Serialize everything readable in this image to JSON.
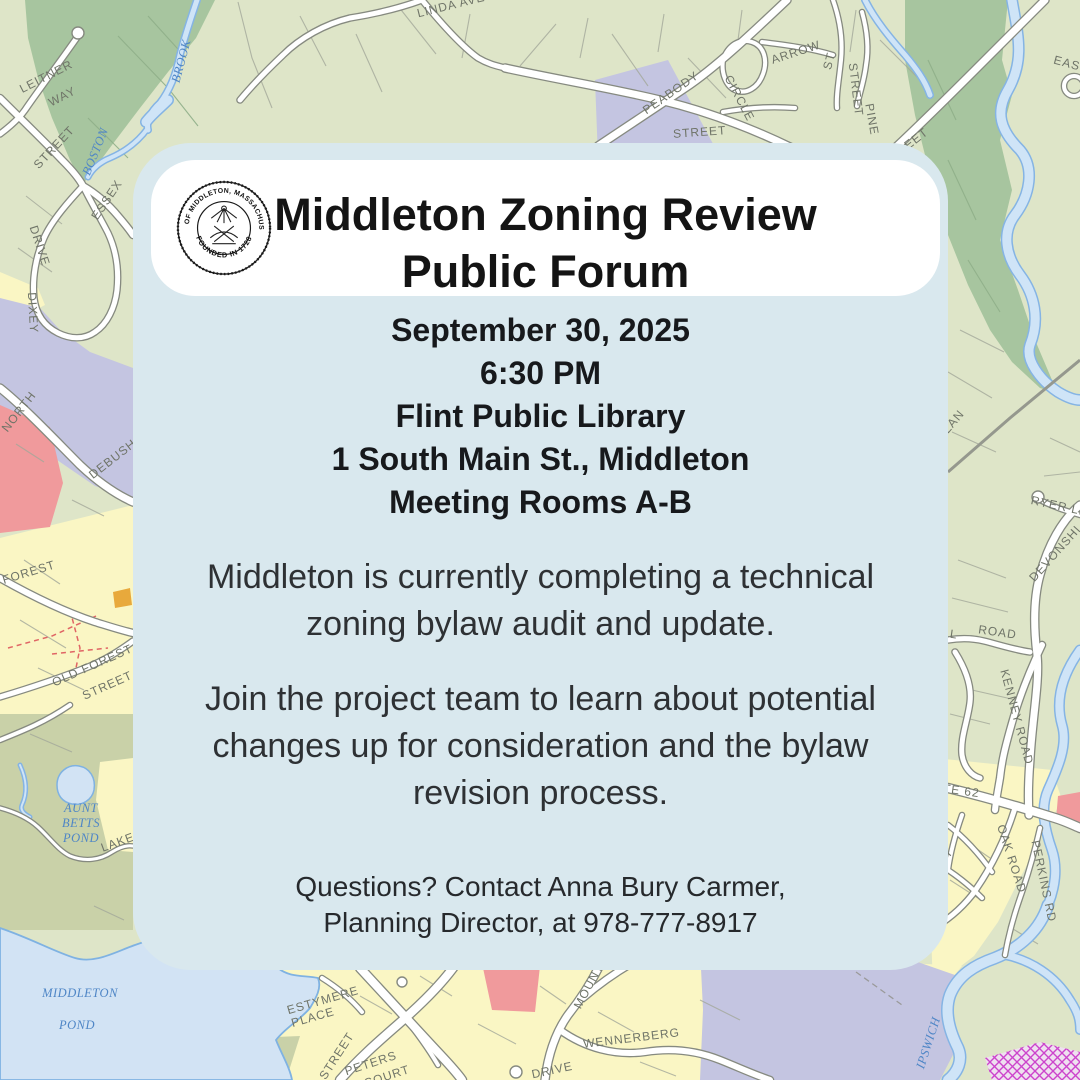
{
  "card": {
    "title": {
      "line1": "Middleton Zoning Review",
      "line2": "Public Forum"
    },
    "seal": {
      "ring_top": "TOWN OF MIDDLETON, MASSACHUSETTS",
      "ring_bottom": "FOUNDED IN 1728"
    },
    "details": [
      "September 30, 2025",
      "6:30 PM",
      "Flint Public Library",
      "1 South Main St., Middleton",
      "Meeting Rooms A-B"
    ],
    "body": {
      "p1": [
        "Middleton is currently completing a technical",
        "zoning bylaw audit and update."
      ],
      "p2": [
        "Join the project team to learn about potential",
        "changes up for consideration and the bylaw",
        "revision process."
      ]
    },
    "contact": [
      "Questions? Contact Anna Bury Carmer,",
      "Planning Director, at 978-777-8917"
    ]
  },
  "colors": {
    "card_bg": "#d9e8ee",
    "pill_bg": "#ffffff",
    "title_text": "#141414",
    "body_text": "#2e3134",
    "map_sage": "#dee5c8",
    "map_forest": "#a7c59f",
    "map_olive": "#c9d1a8",
    "map_lavender": "#c4c5e1",
    "map_yellow": "#faf6c4",
    "map_pink": "#f09a9c",
    "map_orange": "#e8a93c",
    "map_water": "#cfe4f7",
    "map_water_edge": "#85b4e4",
    "road_fill": "#ffffff",
    "road_casing": "#868a80"
  },
  "map": {
    "labels": [
      {
        "t": "LEITNER",
        "x": 48,
        "y": 80,
        "r": -27,
        "k": "s"
      },
      {
        "t": "WAY",
        "x": 64,
        "y": 100,
        "r": -27,
        "k": "s"
      },
      {
        "t": "STREET",
        "x": 57,
        "y": 150,
        "r": -47,
        "k": "s"
      },
      {
        "t": "ESSEX",
        "x": 110,
        "y": 202,
        "r": -56,
        "k": "s"
      },
      {
        "t": "DRIVE",
        "x": 36,
        "y": 247,
        "r": 72,
        "k": "s"
      },
      {
        "t": "DIXEY",
        "x": 29,
        "y": 313,
        "r": 87,
        "k": "s"
      },
      {
        "t": "NORTH",
        "x": 22,
        "y": 414,
        "r": -52,
        "k": "s"
      },
      {
        "t": "DEBUSH",
        "x": 115,
        "y": 462,
        "r": -38,
        "k": "s"
      },
      {
        "t": "FOREST",
        "x": 30,
        "y": 576,
        "r": -17,
        "k": "s"
      },
      {
        "t": "OLD FOREST",
        "x": 94,
        "y": 669,
        "r": -24,
        "k": "s"
      },
      {
        "t": "STREET",
        "x": 109,
        "y": 689,
        "r": -24,
        "k": "s"
      },
      {
        "t": "LAKE",
        "x": 119,
        "y": 846,
        "r": -20,
        "k": "s"
      },
      {
        "t": "LINDA AVE",
        "x": 452,
        "y": 9,
        "r": -14,
        "k": "s"
      },
      {
        "t": "PEABODY",
        "x": 673,
        "y": 96,
        "r": -35,
        "k": "s"
      },
      {
        "t": "ARROW",
        "x": 797,
        "y": 56,
        "r": -18,
        "k": "s"
      },
      {
        "t": "ST",
        "x": 833,
        "y": 62,
        "r": -75,
        "k": "s"
      },
      {
        "t": "CIRCLE",
        "x": 736,
        "y": 100,
        "r": 62,
        "k": "s"
      },
      {
        "t": "STREET",
        "x": 852,
        "y": 90,
        "r": 83,
        "k": "s"
      },
      {
        "t": "PINE",
        "x": 868,
        "y": 120,
        "r": 80,
        "k": "s"
      },
      {
        "t": "STREET",
        "x": 700,
        "y": 136,
        "r": -4,
        "k": "s"
      },
      {
        "t": "STREET",
        "x": 908,
        "y": 150,
        "r": -38,
        "k": "s"
      },
      {
        "t": "EAST",
        "x": 1070,
        "y": 68,
        "r": 15,
        "k": "s"
      },
      {
        "t": "RYER LN",
        "x": 1059,
        "y": 510,
        "r": 12,
        "k": "s"
      },
      {
        "t": "DEVONSHI",
        "x": 1058,
        "y": 556,
        "r": -48,
        "k": "s"
      },
      {
        "t": "ELL",
        "x": 945,
        "y": 637,
        "r": 8,
        "k": "s"
      },
      {
        "t": "ROAD",
        "x": 997,
        "y": 636,
        "r": 8,
        "k": "s"
      },
      {
        "t": "KENNEY ROAD",
        "x": 1013,
        "y": 718,
        "r": 75,
        "k": "s"
      },
      {
        "t": "OLAN",
        "x": 953,
        "y": 428,
        "r": -50,
        "k": "s"
      },
      {
        "t": "UTE 62",
        "x": 956,
        "y": 794,
        "r": 8,
        "k": "s"
      },
      {
        "t": "OAK ROAD",
        "x": 1008,
        "y": 860,
        "r": 72,
        "k": "s"
      },
      {
        "t": "AVE ST",
        "x": 938,
        "y": 870,
        "r": -48,
        "k": "s"
      },
      {
        "t": "PERKINS RD",
        "x": 1040,
        "y": 882,
        "r": 78,
        "k": "s"
      },
      {
        "t": "STREET",
        "x": 340,
        "y": 1058,
        "r": -57,
        "k": "s"
      },
      {
        "t": "PETERS",
        "x": 372,
        "y": 1067,
        "r": -18,
        "k": "s"
      },
      {
        "t": "COURT",
        "x": 388,
        "y": 1080,
        "r": -18,
        "k": "s"
      },
      {
        "t": "ESTYMERE",
        "x": 324,
        "y": 1004,
        "r": -16,
        "k": "s"
      },
      {
        "t": "PLACE",
        "x": 314,
        "y": 1021,
        "r": -16,
        "k": "s"
      },
      {
        "t": "MOUNT",
        "x": 592,
        "y": 988,
        "r": -62,
        "k": "s"
      },
      {
        "t": "WENNERBERG",
        "x": 632,
        "y": 1042,
        "r": -7,
        "k": "s"
      },
      {
        "t": "DRIVE",
        "x": 553,
        "y": 1074,
        "r": -12,
        "k": "s"
      },
      {
        "t": "BOSTON",
        "x": 99,
        "y": 153,
        "r": -68,
        "k": "w"
      },
      {
        "t": "BROOK",
        "x": 185,
        "y": 62,
        "r": -75,
        "k": "w"
      },
      {
        "t": "AUNT",
        "x": 81,
        "y": 812,
        "r": 0,
        "k": "w"
      },
      {
        "t": "BETTS",
        "x": 81,
        "y": 827,
        "r": 0,
        "k": "w"
      },
      {
        "t": "POND",
        "x": 81,
        "y": 842,
        "r": 0,
        "k": "w"
      },
      {
        "t": "MIDDLETON",
        "x": 80,
        "y": 997,
        "r": 0,
        "k": "w"
      },
      {
        "t": "POND",
        "x": 77,
        "y": 1029,
        "r": 0,
        "k": "w"
      },
      {
        "t": "IPSWICH",
        "x": 932,
        "y": 1044,
        "r": -72,
        "k": "w"
      }
    ]
  }
}
